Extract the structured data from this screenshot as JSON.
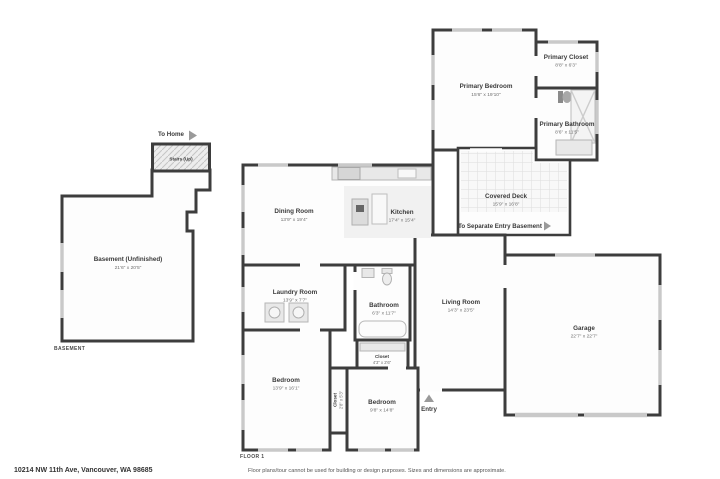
{
  "annotations": {
    "to_home": "To Home",
    "stairs": "Stairs (Up)",
    "to_separate_entry": "To Separate Entry Basement",
    "entry": "Entry",
    "basement_level": "BASEMENT",
    "floor1_level": "FLOOR 1"
  },
  "rooms": {
    "basement": {
      "name": "Basement (Unfinished)",
      "dims": "21'6\" x 20'5\""
    },
    "dining": {
      "name": "Dining Room",
      "dims": "13'9\" x 19'4\""
    },
    "kitchen": {
      "name": "Kitchen",
      "dims": "17'4\" x 15'4\""
    },
    "primary_bedroom": {
      "name": "Primary Bedroom",
      "dims": "15'6\" x 19'10\""
    },
    "primary_closet": {
      "name": "Primary Closet",
      "dims": "8'8\" x 6'3\""
    },
    "primary_bathroom": {
      "name": "Primary Bathroom",
      "dims": "8'6\" x 11'5\""
    },
    "covered_deck": {
      "name": "Covered Deck",
      "dims": "15'9\" x 16'8\""
    },
    "laundry": {
      "name": "Laundry Room",
      "dims": "13'9\" x 7'7\""
    },
    "bathroom": {
      "name": "Bathroom",
      "dims": "6'3\" x 11'7\""
    },
    "living": {
      "name": "Living Room",
      "dims": "14'3\" x 23'5\""
    },
    "garage": {
      "name": "Garage",
      "dims": "22'7\" x 22'7\""
    },
    "closet_hall": {
      "name": "Closet",
      "dims": "4'3\" x 2'6\""
    },
    "closet_bedroom": {
      "name": "Closet",
      "dims": "2'8\" x 5'3\""
    },
    "bedroom_left": {
      "name": "Bedroom",
      "dims": "13'9\" x 16'1\""
    },
    "bedroom_right": {
      "name": "Bedroom",
      "dims": "9'8\" x 14'8\""
    }
  },
  "footer": {
    "address": "10214 NW 11th Ave, Vancouver, WA 98685",
    "disclaimer": "Floor plans/tour cannot be used for building or design purposes. Sizes and dimensions are approximate."
  },
  "colors": {
    "wall": "#3d3d3d",
    "window_marker": "#c9c9c9",
    "fixture_fill": "#e8e8e8",
    "room_name_text": "#3b3b3b",
    "dimension_text": "#6e6e6e",
    "arrow": "#9a9a9a"
  }
}
